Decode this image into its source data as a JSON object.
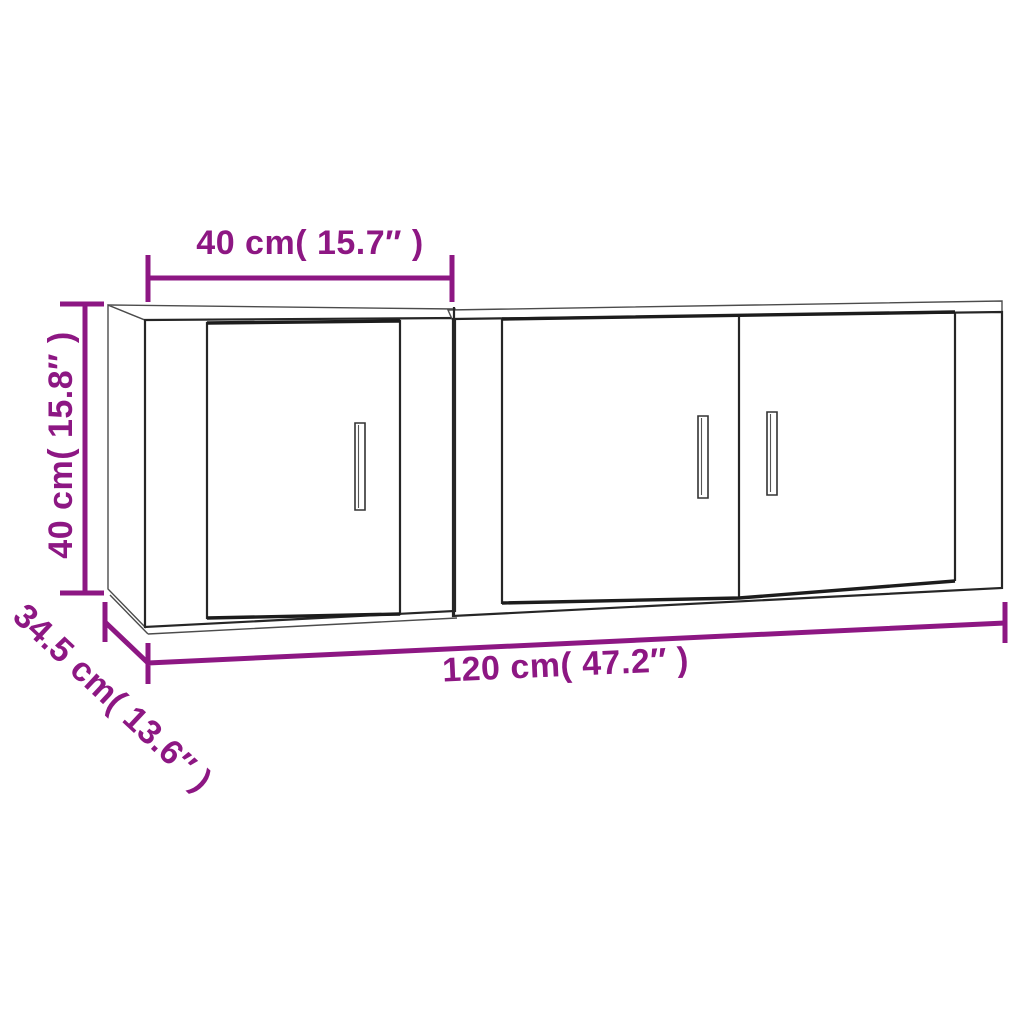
{
  "diagram": {
    "kind": "furniture-dimension-line-drawing",
    "colors": {
      "dimension_accent": "#8d1783",
      "drawing_line": "#262626",
      "background": "#ffffff"
    },
    "dimensions": {
      "cabinet_width": {
        "label": "40 cm( 15.7″ )",
        "cm": 40,
        "inches": 15.7,
        "position": "top"
      },
      "cabinet_height": {
        "label": "40 cm( 15.8″ )",
        "cm": 40,
        "inches": 15.8,
        "position": "left-rotated"
      },
      "cabinet_depth": {
        "label": "34.5 cm( 13.6″ )",
        "cm": 34.5,
        "inches": 13.6,
        "position": "bottom-left-diagonal"
      },
      "total_width": {
        "label": "120 cm( 47.2″ )",
        "cm": 120,
        "inches": 47.2,
        "position": "bottom"
      }
    },
    "objects": {
      "left_cabinet": {
        "doors": 1,
        "handles": 1
      },
      "right_cabinet": {
        "doors": 2,
        "handles": 2
      }
    }
  }
}
